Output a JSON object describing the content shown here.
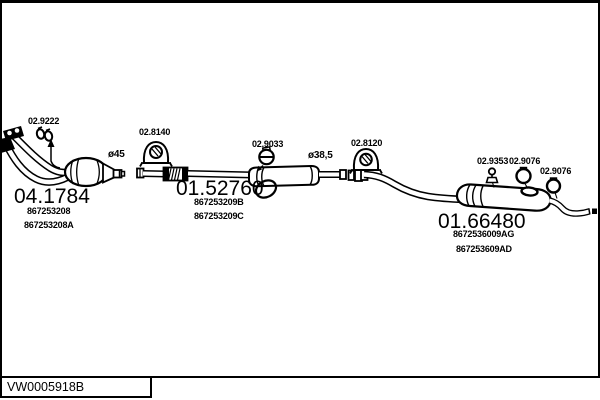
{
  "page": {
    "background": "#ffffff",
    "line_color": "#000000",
    "drawing_number": "VW0005918B"
  },
  "assemblies": [
    {
      "component": "front-pipe-catalytic-converter",
      "code": "04.1784",
      "part_numbers": [
        "867253208",
        "867253208A"
      ],
      "diameter": "ø45"
    },
    {
      "component": "centre-silencer",
      "code": "01.52760",
      "part_numbers": [
        "867253209B",
        "867253209C"
      ],
      "diameter": "ø38,5"
    },
    {
      "component": "rear-silencer",
      "code": "01.66480",
      "part_numbers": [
        "8672536009AG",
        "867253609AD"
      ]
    }
  ],
  "fittings": [
    {
      "code": "02.9222",
      "type": "pipe-clamp-pair"
    },
    {
      "code": "02.8140",
      "type": "rubber-hanger"
    },
    {
      "code": "02.9033",
      "type": "muffler-clamp"
    },
    {
      "code": "02.8120",
      "type": "rubber-hanger"
    },
    {
      "code": "02.9353",
      "type": "hanger-pin"
    },
    {
      "code": "02.9076",
      "type": "hanger-ring"
    },
    {
      "code": "02.9076",
      "type": "hanger-ring"
    }
  ]
}
